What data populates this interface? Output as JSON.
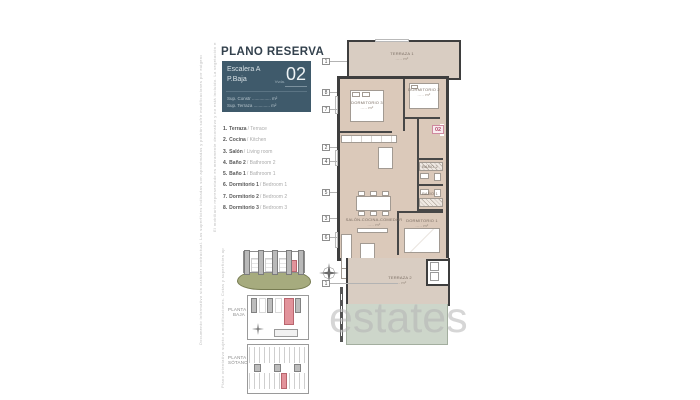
{
  "header": {
    "title": "PLANO RESERVA"
  },
  "unit_card": {
    "escalera": "Escalera A",
    "planta": "P.Baja",
    "unit_prefix": "Vvda.",
    "unit_number": "02",
    "sup_constr": "Sup. Constr ............... m²",
    "sup_terraza": "Sup. Terraza ............. m²"
  },
  "legend": {
    "items": [
      {
        "num": "1.",
        "es": "Terraza",
        "en": "/ Terrace"
      },
      {
        "num": "2.",
        "es": "Cocina",
        "en": "/ Kitchen"
      },
      {
        "num": "3.",
        "es": "Salón",
        "en": "/ Living room"
      },
      {
        "num": "4.",
        "es": "Baño 2",
        "en": "/ Bathroom 2"
      },
      {
        "num": "5.",
        "es": "Baño 1",
        "en": "/ Bathroom 1"
      },
      {
        "num": "6.",
        "es": "Dormitorio 1",
        "en": "/ Bedroom 1"
      },
      {
        "num": "7.",
        "es": "Dormitorio 2",
        "en": "/ Bedroom 2"
      },
      {
        "num": "8.",
        "es": "Dormitorio 3",
        "en": "/ Bedroom 3"
      }
    ]
  },
  "plan": {
    "unit_badge": "02",
    "callouts": [
      "1",
      "8",
      "7",
      "2",
      "4",
      "5",
      "3",
      "6",
      "1"
    ],
    "rooms": {
      "terraza1": {
        "name": "TERRAZA 1",
        "area": "..... m²"
      },
      "dormitorio3": {
        "name": "DORMITORIO 3",
        "area": "..... m²"
      },
      "dormitorio2": {
        "name": "DORMITORIO 2",
        "area": "..... m²"
      },
      "bano2": {
        "name": "BAÑO 2",
        "area": "... m²"
      },
      "bano1": {
        "name": "BAÑO 1",
        "area": "... m²"
      },
      "salon": {
        "name": "SALÓN-COCINA-COMEDOR",
        "area": "..... m²"
      },
      "dormitorio1": {
        "name": "DORMITORIO 1",
        "area": "..... m²"
      },
      "terraza2": {
        "name": "TERRAZA 2",
        "area": "..... m²"
      }
    }
  },
  "thumbnails": {
    "planta_baja": "PLANTA BAJA",
    "planta_sotano": "PLANTA SÓTANO"
  },
  "watermark": "estates.c",
  "disclaimers": {
    "d1": "Documento informativo sin carácter contractual. Las superficies indicadas son aproximadas y podrán sufrir modificaciones por exigencias técnicas, jurídicas o comerciales de la dirección facultativa.",
    "d2": "El mobiliario representado es meramente decorativo y no está incluido. La vegetación es orientativa.",
    "d3": "Plano orientativo sujeto a modificaciones. Cotas y superficies aproximadas."
  }
}
